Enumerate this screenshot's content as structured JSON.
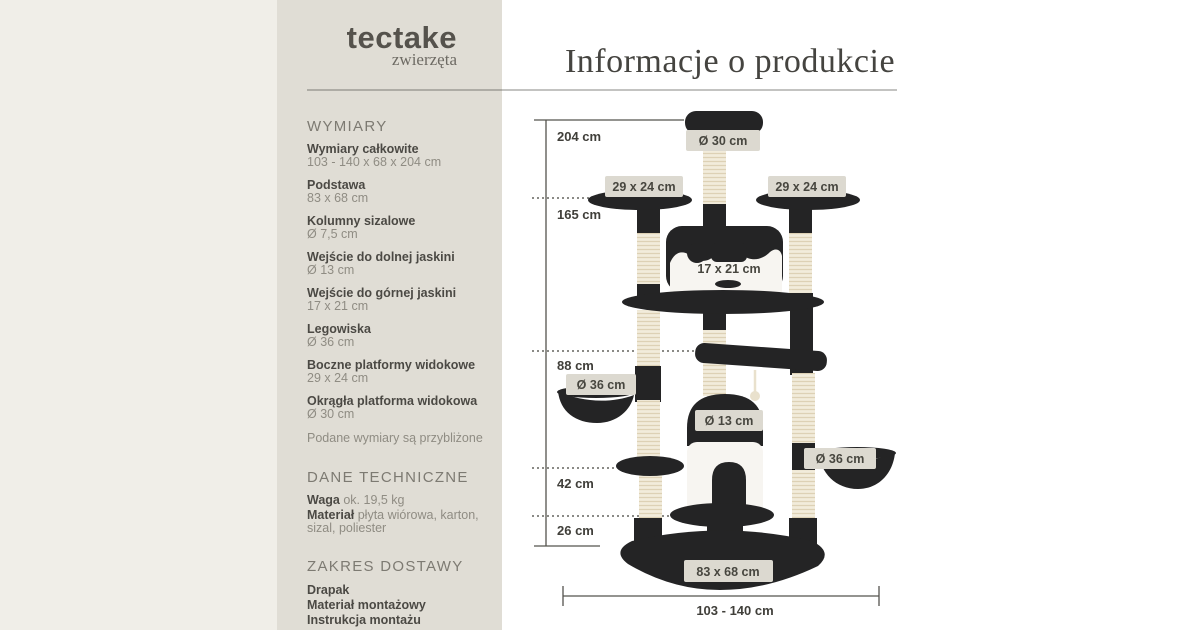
{
  "colors": {
    "sidebar_bg": "#e0ddd5",
    "left_strip_bg": "#f0eee8",
    "main_bg": "#ffffff",
    "dark_plush": "#242425",
    "sisal": "#f2ecdb",
    "label_chip_bg": "#dcd9d0",
    "text_dark": "#4b4944",
    "text_muted": "#8f8c83",
    "heading_gray": "#7d7a72"
  },
  "brand": {
    "name": "tectake",
    "subtitle": "zwierzęta"
  },
  "main": {
    "title": "Informacje o produkcie"
  },
  "sidebar": {
    "sections": [
      {
        "heading": "WYMIARY",
        "entries": [
          {
            "label": "Wymiary całkowite",
            "value": "103 - 140 x 68 x 204 cm"
          },
          {
            "label": "Podstawa",
            "value": "83 x 68 cm"
          },
          {
            "label": "Kolumny sizalowe",
            "value": "Ø 7,5 cm"
          },
          {
            "label": "Wejście do dolnej jaskini",
            "value": "Ø 13 cm"
          },
          {
            "label": "Wejście do górnej jaskini",
            "value": "17 x 21 cm"
          },
          {
            "label": "Legowiska",
            "value": "Ø 36 cm"
          },
          {
            "label": "Boczne platformy widokowe",
            "value": "29 x 24 cm"
          },
          {
            "label": "Okrągła platforma widokowa",
            "value": "Ø 30 cm"
          }
        ],
        "note": "Podane wymiary są przybliżone"
      },
      {
        "heading": "DANE TECHNICZNE",
        "entries": [
          {
            "label": "Waga",
            "value": "ok. 19,5 kg"
          },
          {
            "label": "Materiał",
            "value": "płyta wiórowa, karton, sizal, poliester"
          }
        ]
      },
      {
        "heading": "ZAKRES DOSTAWY",
        "items": [
          "Drapak",
          "Materiał montażowy",
          "Instrukcja montażu"
        ]
      }
    ]
  },
  "diagram": {
    "heights": {
      "total": "204 cm",
      "h165": "165 cm",
      "h88": "88 cm",
      "h42": "42 cm",
      "h26": "26 cm"
    },
    "width_range": "103 - 140 cm",
    "labels": {
      "top_platform": "Ø 30 cm",
      "left_platform": "29 x 24 cm",
      "right_platform": "29 x 24 cm",
      "upper_cave_entry": "17 x 21 cm",
      "left_bed": "Ø 36 cm",
      "lower_cave_entry": "Ø 13 cm",
      "right_bed": "Ø 36 cm",
      "base": "83 x 68 cm"
    }
  }
}
